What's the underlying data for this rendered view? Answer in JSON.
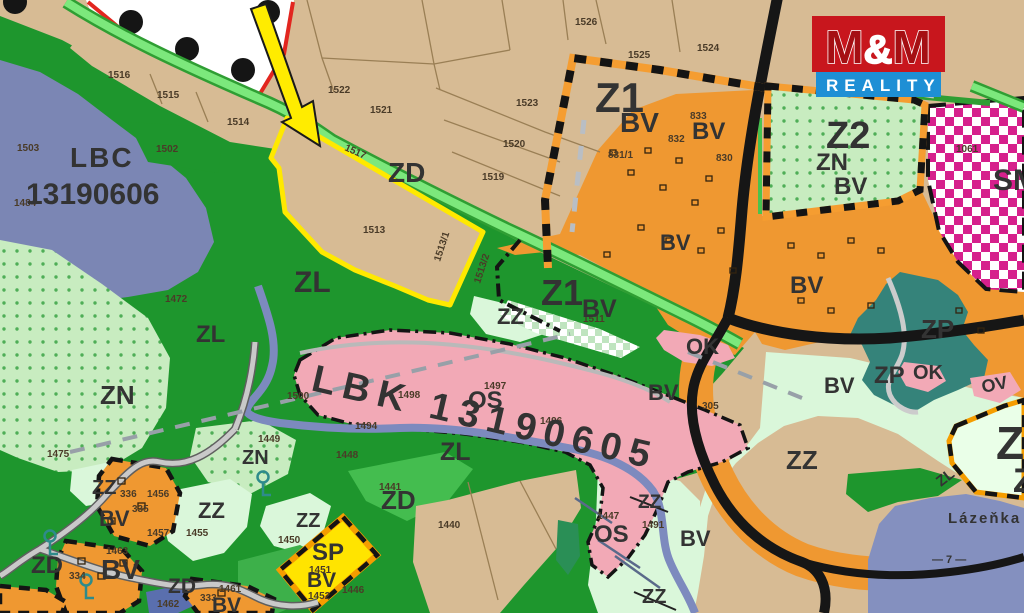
{
  "logo": {
    "m1": "M",
    "amp": "&",
    "m2": "M",
    "reality": "REALITY",
    "red": "#c8161d",
    "blue": "#1e8fd5"
  },
  "palette": {
    "farmland_tan": "#d7bb94",
    "forest_green": "#1e962d",
    "meadow_mint": "#daf7da",
    "dotted_green": "#c8ecc0",
    "builtup_orange": "#ef9831",
    "sport_pink": "#f2a9b6",
    "biocenter_slate": "#7b86b4",
    "water_slate": "#8490bf",
    "park_teal": "#35837a",
    "mixed_magenta": "#d6208c",
    "highlight_yellow": "#ffe900",
    "sp_yellow": "#ffe400",
    "zone_blue_text": "#38288c",
    "road_black": "#161616",
    "border_red": "#e2261f"
  },
  "zone_labels": [
    {
      "text": "LBC",
      "x": 70,
      "y": 167,
      "size": 28,
      "color": "#5a6e60",
      "ls": 2
    },
    {
      "text": "13190606",
      "x": 26,
      "y": 204,
      "size": 30,
      "color": "#5a6e60"
    },
    {
      "text": "LBK 13190605",
      "x": 310,
      "y": 390,
      "size": 38,
      "color": "#7a827a",
      "rot": 13,
      "ls": 8
    },
    {
      "text": "Z1",
      "x": 595,
      "y": 112,
      "size": 42,
      "color": "#38288c"
    },
    {
      "text": "BV",
      "x": 620,
      "y": 132,
      "size": 28,
      "color": "#3a3a3a"
    },
    {
      "text": "BV",
      "x": 692,
      "y": 139,
      "size": 24,
      "color": "#3a3a3a"
    },
    {
      "text": "Z2",
      "x": 826,
      "y": 148,
      "size": 38,
      "color": "#38288c"
    },
    {
      "text": "ZN",
      "x": 816,
      "y": 170,
      "size": 24
    },
    {
      "text": "BV",
      "x": 834,
      "y": 194,
      "size": 24
    },
    {
      "text": "SM",
      "x": 993,
      "y": 190,
      "size": 30,
      "color": "#ffffff"
    },
    {
      "text": "ZD",
      "x": 388,
      "y": 182,
      "size": 28
    },
    {
      "text": "ZL",
      "x": 294,
      "y": 292,
      "size": 30
    },
    {
      "text": "ZL",
      "x": 196,
      "y": 342,
      "size": 24
    },
    {
      "text": "ZN",
      "x": 100,
      "y": 404,
      "size": 26
    },
    {
      "text": "Z1",
      "x": 541,
      "y": 305,
      "size": 36,
      "color": "#38288c"
    },
    {
      "text": "BV",
      "x": 582,
      "y": 317,
      "size": 25,
      "color": "#3a3a3a"
    },
    {
      "text": "ZZ",
      "x": 497,
      "y": 324,
      "size": 22
    },
    {
      "text": "OS",
      "x": 468,
      "y": 408,
      "size": 24
    },
    {
      "text": "ZL",
      "x": 440,
      "y": 460,
      "size": 25
    },
    {
      "text": "ZN",
      "x": 242,
      "y": 464,
      "size": 20
    },
    {
      "text": "ZZ",
      "x": 92,
      "y": 494,
      "size": 20
    },
    {
      "text": "ZZ",
      "x": 198,
      "y": 518,
      "size": 22
    },
    {
      "text": "ZZ",
      "x": 296,
      "y": 527,
      "size": 20
    },
    {
      "text": "BV",
      "x": 99,
      "y": 526,
      "size": 22
    },
    {
      "text": "ZD",
      "x": 31,
      "y": 573,
      "size": 24
    },
    {
      "text": "BV",
      "x": 101,
      "y": 579,
      "size": 28
    },
    {
      "text": "ZD",
      "x": 381,
      "y": 509,
      "size": 26
    },
    {
      "text": "SP",
      "x": 312,
      "y": 560,
      "size": 24
    },
    {
      "text": "BV",
      "x": 307,
      "y": 587,
      "size": 21
    },
    {
      "text": "ZD",
      "x": 168,
      "y": 593,
      "size": 21,
      "color": "#1f8585"
    },
    {
      "text": "BV",
      "x": 212,
      "y": 612,
      "size": 21
    },
    {
      "text": "OS",
      "x": 594,
      "y": 542,
      "size": 24
    },
    {
      "text": "ZZ",
      "x": 638,
      "y": 508,
      "size": 19
    },
    {
      "text": "ZZ",
      "x": 642,
      "y": 603,
      "size": 20
    },
    {
      "text": "BV",
      "x": 680,
      "y": 546,
      "size": 22
    },
    {
      "text": "BV",
      "x": 648,
      "y": 400,
      "size": 22
    },
    {
      "text": "BV",
      "x": 660,
      "y": 250,
      "size": 22
    },
    {
      "text": "OK",
      "x": 686,
      "y": 354,
      "size": 22
    },
    {
      "text": "BV",
      "x": 790,
      "y": 293,
      "size": 24
    },
    {
      "text": "BV",
      "x": 824,
      "y": 393,
      "size": 22
    },
    {
      "text": "ZZ",
      "x": 786,
      "y": 469,
      "size": 26
    },
    {
      "text": "ZP",
      "x": 921,
      "y": 338,
      "size": 26
    },
    {
      "text": "ZP",
      "x": 874,
      "y": 383,
      "size": 24
    },
    {
      "text": "OK",
      "x": 913,
      "y": 379,
      "size": 20
    },
    {
      "text": "OV",
      "x": 983,
      "y": 393,
      "size": 18,
      "rot": -12
    },
    {
      "text": "Z",
      "x": 996,
      "y": 459,
      "size": 46,
      "color": "#38288c"
    },
    {
      "text": "Z",
      "x": 1013,
      "y": 492,
      "size": 34,
      "color": "#38288c"
    },
    {
      "text": "ZL",
      "x": 941,
      "y": 487,
      "size": 15,
      "rot": -38
    },
    {
      "text": "Lázeňka",
      "x": 948,
      "y": 523,
      "size": 15,
      "color": "#2e3a66",
      "ls": 2
    },
    {
      "text": "— 7 —",
      "x": 932,
      "y": 563,
      "size": 11,
      "color": "#2e3a66"
    }
  ],
  "parcel_labels": [
    {
      "text": "1516",
      "x": 108,
      "y": 78
    },
    {
      "text": "1515",
      "x": 157,
      "y": 98
    },
    {
      "text": "1514",
      "x": 227,
      "y": 125
    },
    {
      "text": "1503",
      "x": 17,
      "y": 151
    },
    {
      "text": "1502",
      "x": 156,
      "y": 152
    },
    {
      "text": "1484",
      "x": 14,
      "y": 206
    },
    {
      "text": "1522",
      "x": 328,
      "y": 93
    },
    {
      "text": "1521",
      "x": 370,
      "y": 113
    },
    {
      "text": "1523",
      "x": 516,
      "y": 106
    },
    {
      "text": "1520",
      "x": 503,
      "y": 147
    },
    {
      "text": "1519",
      "x": 482,
      "y": 180
    },
    {
      "text": "1526",
      "x": 575,
      "y": 25
    },
    {
      "text": "1525",
      "x": 628,
      "y": 58
    },
    {
      "text": "1524",
      "x": 697,
      "y": 51
    },
    {
      "text": "1517",
      "x": 344,
      "y": 150,
      "rot": 24
    },
    {
      "text": "1513",
      "x": 363,
      "y": 233
    },
    {
      "text": "1513/1",
      "x": 440,
      "y": 262,
      "rot": -72
    },
    {
      "text": "1513/2",
      "x": 480,
      "y": 284,
      "rot": -72
    },
    {
      "text": "1472",
      "x": 165,
      "y": 302
    },
    {
      "text": "1475",
      "x": 47,
      "y": 457
    },
    {
      "text": "1449",
      "x": 258,
      "y": 442
    },
    {
      "text": "1448",
      "x": 336,
      "y": 458
    },
    {
      "text": "1500",
      "x": 287,
      "y": 399
    },
    {
      "text": "1494",
      "x": 355,
      "y": 429
    },
    {
      "text": "1498",
      "x": 398,
      "y": 398
    },
    {
      "text": "1497",
      "x": 484,
      "y": 389
    },
    {
      "text": "1496",
      "x": 540,
      "y": 424
    },
    {
      "text": "1511",
      "x": 583,
      "y": 322
    },
    {
      "text": "831/1",
      "x": 608,
      "y": 158
    },
    {
      "text": "832",
      "x": 668,
      "y": 142
    },
    {
      "text": "833",
      "x": 690,
      "y": 119
    },
    {
      "text": "830",
      "x": 716,
      "y": 161
    },
    {
      "text": "1061",
      "x": 956,
      "y": 152
    },
    {
      "text": "336",
      "x": 120,
      "y": 497
    },
    {
      "text": "335",
      "x": 132,
      "y": 512
    },
    {
      "text": "1456",
      "x": 147,
      "y": 497
    },
    {
      "text": "1457",
      "x": 147,
      "y": 536
    },
    {
      "text": "1455",
      "x": 186,
      "y": 536
    },
    {
      "text": "1463",
      "x": 106,
      "y": 554
    },
    {
      "text": "334",
      "x": 69,
      "y": 579
    },
    {
      "text": "1462",
      "x": 157,
      "y": 607
    },
    {
      "text": "333",
      "x": 200,
      "y": 601
    },
    {
      "text": "1461",
      "x": 219,
      "y": 592
    },
    {
      "text": "1441",
      "x": 379,
      "y": 490
    },
    {
      "text": "1440",
      "x": 438,
      "y": 528
    },
    {
      "text": "1450",
      "x": 278,
      "y": 543
    },
    {
      "text": "1451",
      "x": 309,
      "y": 573
    },
    {
      "text": "1452",
      "x": 308,
      "y": 599
    },
    {
      "text": "1446",
      "x": 342,
      "y": 593
    },
    {
      "text": "1447",
      "x": 597,
      "y": 519
    },
    {
      "text": "1491",
      "x": 642,
      "y": 528
    },
    {
      "text": "305",
      "x": 702,
      "y": 409
    }
  ]
}
